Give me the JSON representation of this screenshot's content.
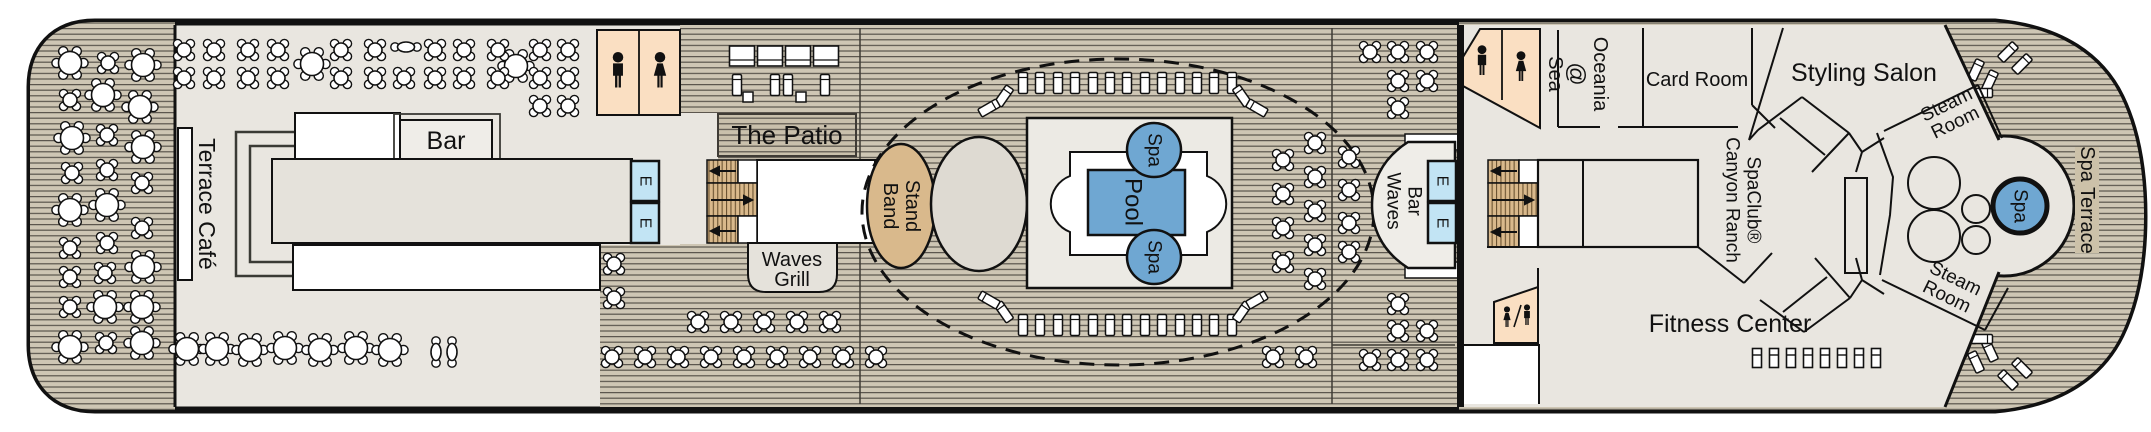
{
  "labels": {
    "terrace_cafe": "Terrace Café",
    "bar": "Bar",
    "the_patio": "The Patio",
    "waves_grill_1": "Waves",
    "waves_grill_2": "Grill",
    "band_stand_1": "Band",
    "band_stand_2": "Stand",
    "pool": "Pool",
    "spa": "Spa",
    "waves_bar_1": "Waves",
    "waves_bar_2": "Bar",
    "oceania_1": "Oceania",
    "oceania_2": "@",
    "oceania_3": "Sea",
    "card_room": "Card Room",
    "canyon_1": "Canyon Ranch",
    "canyon_2": "SpaClub®",
    "styling_salon": "Styling Salon",
    "steam_1": "Steam",
    "steam_2": "Room",
    "fitness_center": "Fitness Center",
    "spa_terrace": "Spa Terrace",
    "elevator": "E"
  },
  "colors": {
    "ink": "#111111",
    "interior": "#E9E6E0",
    "wood": "#CEC6B4",
    "wood_line": "#59544C",
    "panel": "#C9C0AC",
    "terrace_band": "#CCC1A9",
    "peach": "#FADFC2",
    "elevator_blue": "#C2E4F4",
    "pool_blue": "#6FA7D2",
    "tan": "#D9B98C",
    "tread_line": "#6B5332",
    "structure": "#EFEDE8",
    "box_gray": "#E5E2DB",
    "platform": "#ECEAE4",
    "dance": "#DEDAD2",
    "seam": "#3F3B35",
    "white": "#FFFFFF"
  },
  "plan": {
    "tables_r6": [
      [
        70,
        63
      ],
      [
        143,
        65
      ],
      [
        103,
        95
      ],
      [
        140,
        107
      ],
      [
        72,
        138
      ],
      [
        143,
        147
      ],
      [
        70,
        210
      ],
      [
        107,
        205
      ],
      [
        143,
        267
      ],
      [
        105,
        307
      ],
      [
        142,
        307
      ],
      [
        70,
        347
      ],
      [
        142,
        343
      ],
      [
        312,
        64
      ],
      [
        516,
        66
      ],
      [
        187,
        349
      ],
      [
        217,
        349
      ],
      [
        250,
        350
      ],
      [
        285,
        348
      ],
      [
        320,
        350
      ],
      [
        356,
        348
      ],
      [
        390,
        350
      ]
    ],
    "tables_x4": [
      [
        108,
        63
      ],
      [
        70,
        100
      ],
      [
        107,
        135
      ],
      [
        72,
        173
      ],
      [
        107,
        170
      ],
      [
        142,
        183
      ],
      [
        142,
        228
      ],
      [
        70,
        248
      ],
      [
        107,
        243
      ],
      [
        70,
        277
      ],
      [
        105,
        273
      ],
      [
        70,
        307
      ],
      [
        106,
        343
      ],
      [
        184,
        50
      ],
      [
        214,
        50
      ],
      [
        248,
        50
      ],
      [
        278,
        50
      ],
      [
        341,
        50
      ],
      [
        375,
        50
      ],
      [
        435,
        50
      ],
      [
        464,
        50
      ],
      [
        498,
        50
      ],
      [
        540,
        50
      ],
      [
        568,
        50
      ],
      [
        184,
        78
      ],
      [
        214,
        78
      ],
      [
        248,
        78
      ],
      [
        278,
        78
      ],
      [
        341,
        78
      ],
      [
        375,
        78
      ],
      [
        404,
        78
      ],
      [
        435,
        78
      ],
      [
        464,
        78
      ],
      [
        498,
        78
      ],
      [
        540,
        78
      ],
      [
        568,
        78
      ],
      [
        540,
        106
      ],
      [
        568,
        106
      ],
      [
        614,
        264
      ],
      [
        614,
        298
      ],
      [
        612,
        357
      ],
      [
        645,
        357
      ],
      [
        678,
        357
      ],
      [
        711,
        357
      ],
      [
        744,
        357
      ],
      [
        777,
        357
      ],
      [
        810,
        357
      ],
      [
        843,
        357
      ],
      [
        876,
        357
      ],
      [
        698,
        322
      ],
      [
        731,
        322
      ],
      [
        764,
        322
      ],
      [
        797,
        322
      ],
      [
        830,
        322
      ],
      [
        1283,
        160
      ],
      [
        1283,
        194
      ],
      [
        1283,
        228
      ],
      [
        1283,
        262
      ],
      [
        1315,
        143
      ],
      [
        1315,
        177
      ],
      [
        1315,
        211
      ],
      [
        1315,
        245
      ],
      [
        1315,
        279
      ],
      [
        1349,
        157
      ],
      [
        1349,
        190
      ],
      [
        1349,
        223
      ],
      [
        1349,
        252
      ],
      [
        1370,
        52
      ],
      [
        1398,
        52
      ],
      [
        1427,
        52
      ],
      [
        1398,
        81
      ],
      [
        1427,
        81
      ],
      [
        1398,
        108
      ],
      [
        1370,
        360
      ],
      [
        1398,
        360
      ],
      [
        1427,
        360
      ],
      [
        1398,
        331
      ],
      [
        1427,
        331
      ],
      [
        1398,
        304
      ],
      [
        1273,
        357
      ],
      [
        1306,
        357
      ]
    ],
    "tables_sq4": [
      [
        1666,
        46
      ],
      [
        1698,
        46
      ],
      [
        1730,
        46
      ],
      [
        1666,
        112
      ],
      [
        1698,
        112
      ],
      [
        1730,
        112
      ]
    ],
    "tables_pill": [
      [
        406,
        47
      ]
    ],
    "tables_pillv": [
      [
        436,
        352
      ],
      [
        452,
        352
      ]
    ],
    "loungers": [
      [
        1023,
        83,
        0
      ],
      [
        1040,
        83,
        0
      ],
      [
        1058,
        83,
        0
      ],
      [
        1075,
        83,
        0
      ],
      [
        1093,
        83,
        0
      ],
      [
        1110,
        83,
        0
      ],
      [
        1127,
        83,
        0
      ],
      [
        1145,
        83,
        0
      ],
      [
        1162,
        83,
        0
      ],
      [
        1180,
        83,
        0
      ],
      [
        1197,
        83,
        0
      ],
      [
        1214,
        83,
        0
      ],
      [
        1232,
        83,
        0
      ],
      [
        1023,
        325,
        0
      ],
      [
        1040,
        325,
        0
      ],
      [
        1058,
        325,
        0
      ],
      [
        1075,
        325,
        0
      ],
      [
        1093,
        325,
        0
      ],
      [
        1110,
        325,
        0
      ],
      [
        1127,
        325,
        0
      ],
      [
        1145,
        325,
        0
      ],
      [
        1162,
        325,
        0
      ],
      [
        1180,
        325,
        0
      ],
      [
        1197,
        325,
        0
      ],
      [
        1214,
        325,
        0
      ],
      [
        1232,
        325,
        0
      ],
      [
        1004,
        96,
        35
      ],
      [
        989,
        108,
        60
      ],
      [
        1242,
        96,
        -35
      ],
      [
        1257,
        108,
        -60
      ],
      [
        1004,
        312,
        -35
      ],
      [
        989,
        300,
        -60
      ],
      [
        1242,
        312,
        35
      ],
      [
        1257,
        300,
        60
      ],
      [
        737,
        85,
        0
      ],
      [
        775,
        85,
        0
      ],
      [
        788,
        85,
        0
      ],
      [
        825,
        85,
        0
      ],
      [
        2008,
        52,
        45
      ],
      [
        2022,
        64,
        45
      ],
      [
        1976,
        70,
        25
      ],
      [
        1990,
        81,
        25
      ],
      [
        1966,
        93,
        90
      ],
      [
        1982,
        93,
        90
      ],
      [
        2008,
        380,
        -45
      ],
      [
        2022,
        368,
        -45
      ],
      [
        1976,
        362,
        -25
      ],
      [
        1990,
        351,
        -25
      ],
      [
        1966,
        339,
        90
      ],
      [
        1982,
        339,
        90
      ],
      [
        1893,
        311,
        20
      ],
      [
        1911,
        320,
        20
      ],
      [
        1929,
        329,
        20
      ],
      [
        1947,
        338,
        20
      ],
      [
        1965,
        347,
        20
      ],
      [
        1767,
        279,
        45
      ],
      [
        1782,
        290,
        45
      ]
    ],
    "cabanas": [
      [
        742,
        56
      ],
      [
        770,
        56
      ],
      [
        798,
        56
      ],
      [
        826,
        56
      ]
    ],
    "side_tables": [
      [
        748,
        97
      ],
      [
        801,
        97
      ]
    ],
    "equipment": [
      [
        1757,
        358
      ],
      [
        1774,
        358
      ],
      [
        1791,
        358
      ],
      [
        1808,
        358
      ],
      [
        1825,
        358
      ],
      [
        1842,
        358
      ],
      [
        1859,
        358
      ],
      [
        1876,
        358
      ]
    ]
  }
}
